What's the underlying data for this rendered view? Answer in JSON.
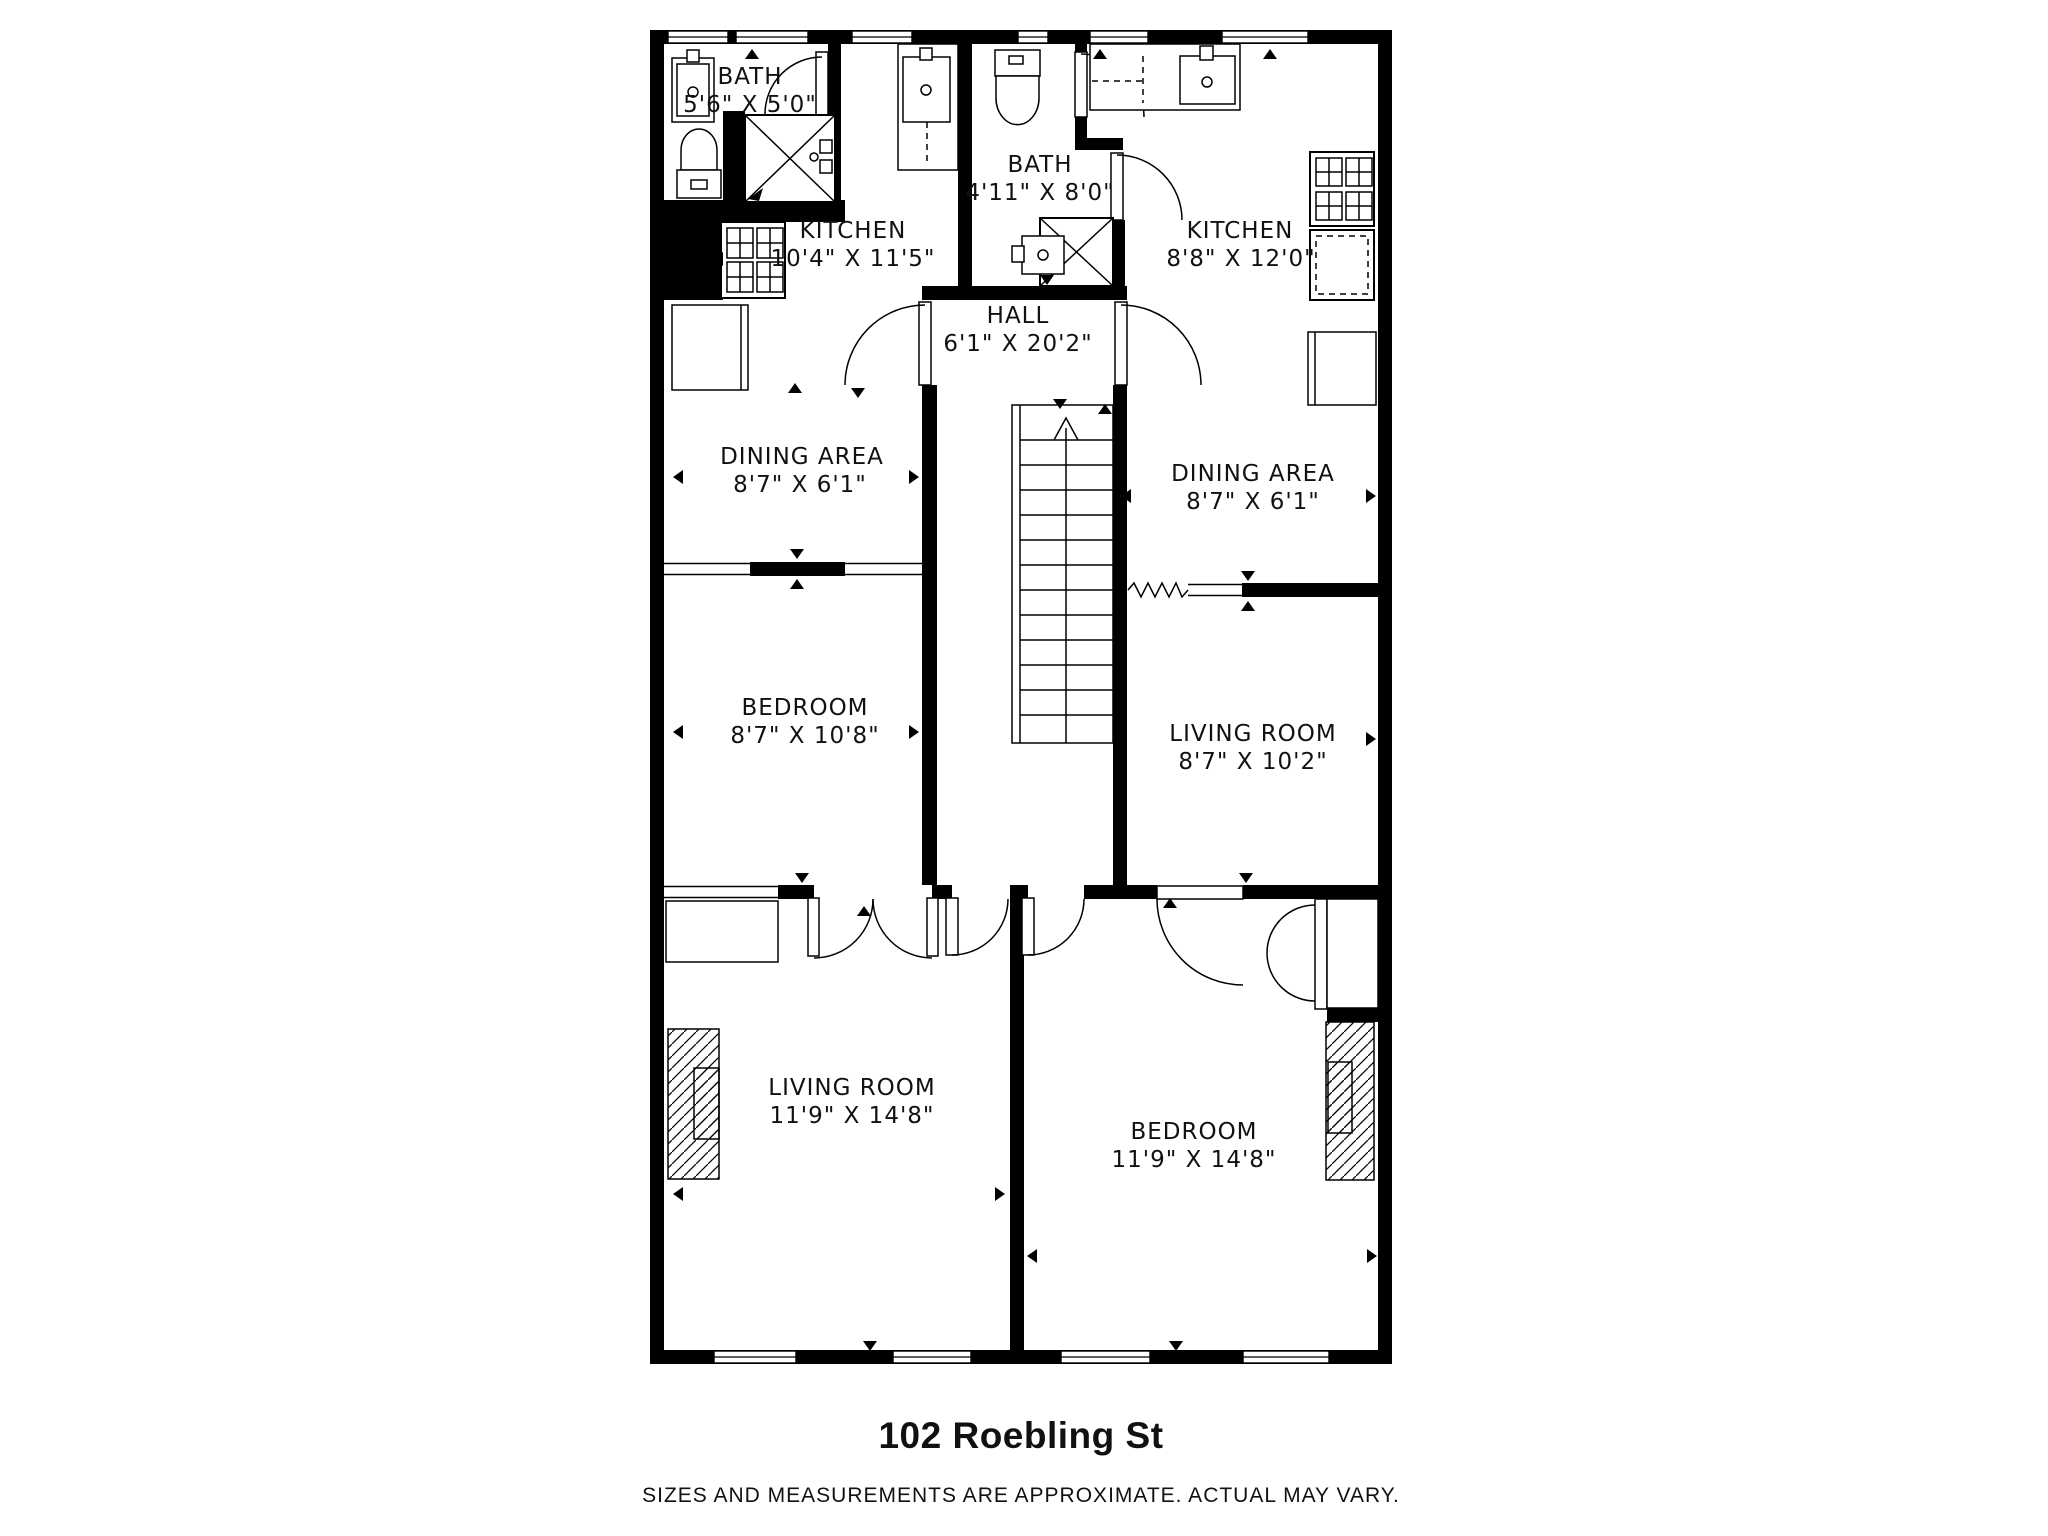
{
  "plan": {
    "title": "102 Roebling St",
    "disclaimer": "SIZES AND MEASUREMENTS ARE APPROXIMATE. ACTUAL MAY VARY.",
    "rooms": [
      {
        "id": "bath-upper-left",
        "name": "BATH",
        "dims": "5'6\" X 5'0\""
      },
      {
        "id": "kitchen-left",
        "name": "KITCHEN",
        "dims": "10'4\" X 11'5\""
      },
      {
        "id": "bath-center",
        "name": "BATH",
        "dims": "4'11\" X 8'0\""
      },
      {
        "id": "kitchen-right",
        "name": "KITCHEN",
        "dims": "8'8\" X 12'0\""
      },
      {
        "id": "hall",
        "name": "HALL",
        "dims": "6'1\" X 20'2\""
      },
      {
        "id": "dining-left",
        "name": "DINING AREA",
        "dims": "8'7\" X 6'1\""
      },
      {
        "id": "dining-right",
        "name": "DINING AREA",
        "dims": "8'7\" X 6'1\""
      },
      {
        "id": "bedroom-upper",
        "name": "BEDROOM",
        "dims": "8'7\" X 10'8\""
      },
      {
        "id": "living-upper",
        "name": "LIVING ROOM",
        "dims": "8'7\" X 10'2\""
      },
      {
        "id": "living-lower",
        "name": "LIVING ROOM",
        "dims": "11'9\" X 14'8\""
      },
      {
        "id": "bedroom-lower",
        "name": "BEDROOM",
        "dims": "11'9\" X 14'8\""
      }
    ],
    "colors": {
      "wall": "#000000",
      "floor": "#ffffff",
      "text": "#111111"
    }
  }
}
